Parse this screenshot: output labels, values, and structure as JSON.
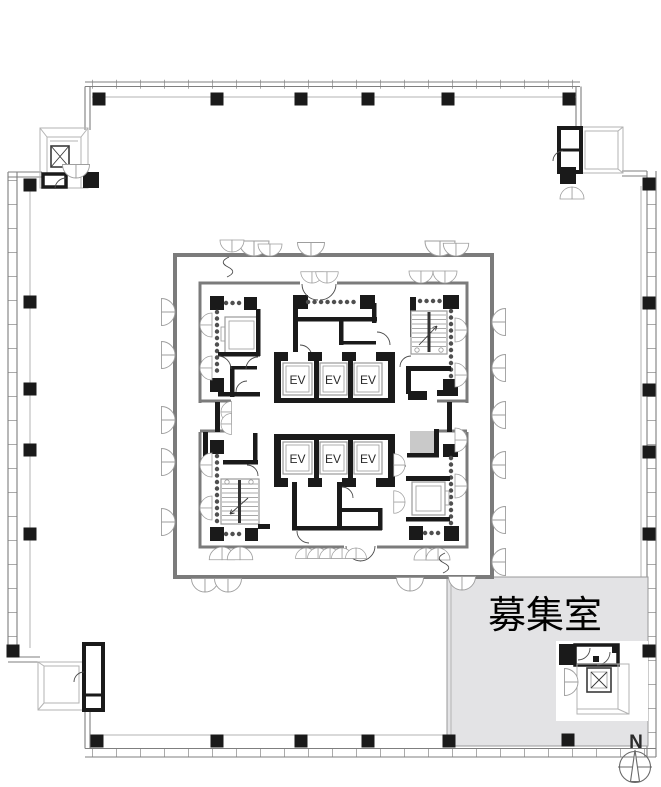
{
  "labels": {
    "elevator": "EV",
    "vacant_room": "募集室",
    "north": "N"
  },
  "colors": {
    "wall": "#1a1a1a",
    "core": "#7b7b7b",
    "vacant": "#e3e3e5",
    "shaft": "#c9c9c9",
    "gray": "#8f8f8f",
    "light": "#a8a8a8"
  }
}
